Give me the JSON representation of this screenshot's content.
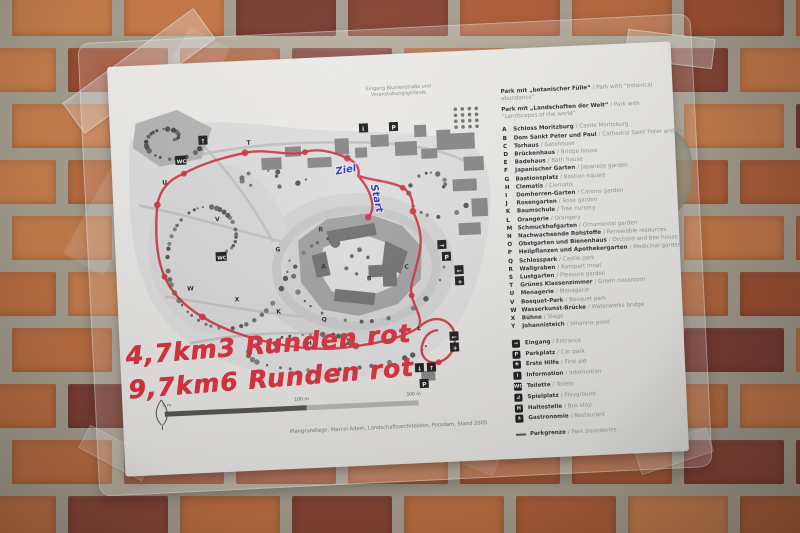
{
  "photo": {
    "wall": {
      "mortar_color": "#ada492",
      "brick_palette": [
        "#c4703d",
        "#b55f35",
        "#cf7b45",
        "#a64f2e",
        "#8a4330",
        "#d08049",
        "#bc6a3a",
        "#7e3b2e"
      ]
    }
  },
  "paper": {
    "top_caption_lines": [
      "Eingang Blumenstraße und",
      "Veranstaltungsgelände"
    ],
    "handwriting": {
      "color": "#e4303c",
      "line1_distance": "4,7km",
      "line1_rounds": "3 Runden rot",
      "line2_distance": "9,7km",
      "line2_rounds": "6 Runden rot",
      "finish_label": "Ziel",
      "start_label": "Start",
      "route_color": "#d8303c"
    },
    "scale_bar": {
      "labels": [
        "0 m",
        "100 m",
        "300 m"
      ]
    },
    "credit": "Plangrundlage: Marcel Adam, Landschaftsarchitekten, Potsdam, Stand 2005",
    "legend": {
      "intro": [
        {
          "de": "Park mit „botanischer Fülle“",
          "en": "/ Park with “botanical abundance”"
        },
        {
          "de": "Park mit „Landschaften der Welt“",
          "en": "/ Park with “Landscapes of the world”"
        }
      ],
      "items": [
        {
          "letter": "A",
          "de": "Schloss Moritzburg",
          "en": "/ Castle Moritzburg"
        },
        {
          "letter": "B",
          "de": "Dom Sankt Peter und Paul",
          "en": "/ Cathedral Saint Peter and Paul"
        },
        {
          "letter": "C",
          "de": "Torhaus",
          "en": "/ Gatehouse"
        },
        {
          "letter": "D",
          "de": "Brückenhaus",
          "en": "/ Bridge house"
        },
        {
          "letter": "E",
          "de": "Badehaus",
          "en": "/ Bath house"
        },
        {
          "letter": "F",
          "de": "Japanischer Garten",
          "en": "/ Japanese garden"
        },
        {
          "letter": "G",
          "de": "Bastionsplatz",
          "en": "/ Bastion square"
        },
        {
          "letter": "H",
          "de": "Clematis",
          "en": "/ Clematis"
        },
        {
          "letter": "I",
          "de": "Domherren-Garten",
          "en": "/ Canons garden"
        },
        {
          "letter": "J",
          "de": "Rosengarten",
          "en": "/ Rose garden"
        },
        {
          "letter": "K",
          "de": "Baumschule",
          "en": "/ Tree nursery"
        },
        {
          "letter": "L",
          "de": "Orangerie",
          "en": "/ Orangery"
        },
        {
          "letter": "M",
          "de": "Schmuckhofgarten",
          "en": "/ Ornamental garden"
        },
        {
          "letter": "N",
          "de": "Nachwachsende Rohstoffe",
          "en": "/ Renewable resources"
        },
        {
          "letter": "O",
          "de": "Obstgarten und Bienenhaus",
          "en": "/ Orchard and bee house"
        },
        {
          "letter": "P",
          "de": "Heilpflanzen und Apothekergarten",
          "en": "/ Medicinal garden"
        },
        {
          "letter": "Q",
          "de": "Schlosspark",
          "en": "/ Castle park"
        },
        {
          "letter": "R",
          "de": "Wallgraben",
          "en": "/ Rampart moat"
        },
        {
          "letter": "S",
          "de": "Lustgarten",
          "en": "/ Pleasure garden"
        },
        {
          "letter": "T",
          "de": "Grünes Klassenzimmer",
          "en": "/ Green classroom"
        },
        {
          "letter": "U",
          "de": "Menagerie",
          "en": "/ Menagerie"
        },
        {
          "letter": "V",
          "de": "Bosquet-Park",
          "en": "/ Bosquet park"
        },
        {
          "letter": "W",
          "de": "Wasserkunst-Brücke",
          "en": "/ Waterworks bridge"
        },
        {
          "letter": "X",
          "de": "Bühne",
          "en": "/ Stage"
        },
        {
          "letter": "Y",
          "de": "Johannisteich",
          "en": "/ Johannis pond"
        }
      ],
      "symbols": [
        {
          "glyph": "→",
          "de": "Eingang",
          "en": "/ Entrance"
        },
        {
          "glyph": "P",
          "de": "Parkplatz",
          "en": "/ Car park"
        },
        {
          "glyph": "✚",
          "de": "Erste Hilfe",
          "en": "/ First aid"
        },
        {
          "glyph": "i",
          "de": "Information",
          "en": "/ Information"
        },
        {
          "glyph": "WC",
          "de": "Toilette",
          "en": "/ Toilets"
        },
        {
          "glyph": "⊿",
          "de": "Spielplatz",
          "en": "/ Playground"
        },
        {
          "glyph": "H",
          "de": "Haltestelle",
          "en": "/ Bus stop"
        },
        {
          "glyph": "⋔",
          "de": "Gastronomie",
          "en": "/ Restaurant"
        }
      ],
      "boundary": {
        "de": "Parkgrenze",
        "en": "/ Park boundaries"
      }
    },
    "map": {
      "markers": [
        "V",
        "G",
        "R",
        "A",
        "B",
        "C",
        "Q",
        "X",
        "W",
        "L",
        "H",
        "T",
        "U",
        "K"
      ],
      "icon_glyphs": {
        "up": "↑",
        "down": "↓",
        "left": "←",
        "right": "→",
        "parking": "P",
        "info": "i",
        "first_aid": "+",
        "wc": "WC"
      }
    }
  }
}
